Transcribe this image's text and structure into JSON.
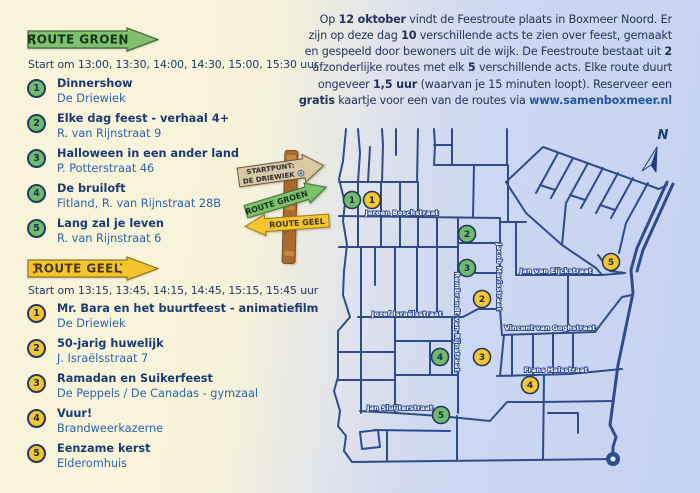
{
  "colors": {
    "green": "#6fbd6b",
    "yellow": "#f6c52d",
    "navy": "#1d3467",
    "blue_text": "#2e62ae",
    "street_blue": "#2e4c8d",
    "bg_left": "#f9f5db",
    "bg_right": "#c6d3f2",
    "post_brown": "#aa6b2c",
    "sign_beige": "#d9c9a4"
  },
  "intro": {
    "segments": [
      {
        "t": "Op "
      },
      {
        "t": "12 oktober",
        "b": true
      },
      {
        "t": " vindt de Feestroute plaats in Boxmeer Noord. Er zijn op deze dag "
      },
      {
        "t": "10",
        "b": true
      },
      {
        "t": " verschillende acts te zien over feest, gemaakt en gespeeld door bewoners uit de wijk. De Feestroute bestaat uit "
      },
      {
        "t": "2",
        "b": true
      },
      {
        "t": " afzonderlijke routes met elk "
      },
      {
        "t": "5",
        "b": true
      },
      {
        "t": " verschillende acts. Elke route duurt ongeveer "
      },
      {
        "t": "1,5 uur",
        "b": true
      },
      {
        "t": " (waarvan je 15 minuten loopt). Reserveer een "
      },
      {
        "t": "gratis",
        "b": true
      },
      {
        "t": " kaartje voor een van de routes via "
      },
      {
        "t": "www.samenboxmeer.nl",
        "b": true,
        "link": true
      }
    ]
  },
  "routes": [
    {
      "id": "groen",
      "banner": "ROUTE GROEN",
      "start": "Start om 13:00, 13:30, 14:00, 14:30, 15:00, 15:30 uur",
      "stops": [
        {
          "num": "1",
          "title": "Dinnershow",
          "location": "De Driewiek"
        },
        {
          "num": "2",
          "title": "Elke dag feest - verhaal 4+",
          "location": "R. van Rijnstraat 9"
        },
        {
          "num": "3",
          "title": "Halloween in een ander land",
          "location": "P. Potterstraat 46"
        },
        {
          "num": "4",
          "title": "De bruiloft",
          "location": "Fitland, R. van Rijnstraat 28B"
        },
        {
          "num": "5",
          "title": "Lang zal je leven",
          "location": "R. van Rijnstraat 6"
        }
      ]
    },
    {
      "id": "geel",
      "banner": "ROUTE GEEL",
      "start": "Start om 13:15, 13:45, 14:15, 14:45, 15:15, 15:45 uur",
      "stops": [
        {
          "num": "1",
          "title": "Mr. Bara en het buurtfeest - animatiefilm",
          "location": "De Driewiek"
        },
        {
          "num": "2",
          "title": "50-jarig huwelijk",
          "location": "J. Israëlsstraat 7"
        },
        {
          "num": "3",
          "title": "Ramadan en Suikerfeest",
          "location": "De Peppels / De Canadas - gymzaal"
        },
        {
          "num": "4",
          "title": "Vuur!",
          "location": "Brandweerkazerne"
        },
        {
          "num": "5",
          "title": "Eenzame kerst",
          "location": "Elderomhuis"
        }
      ]
    }
  ],
  "signpost": {
    "top_line1": "STARTPUNT:",
    "top_line2": "DE DRIEWIEK",
    "green": "ROUTE GROEN",
    "yellow": "ROUTE GEEL"
  },
  "map": {
    "compass": "N",
    "street_labels": [
      {
        "t": "Jeroen Boschstraat",
        "x": 72,
        "y": 90
      },
      {
        "t": "Jan van Eijckstraat",
        "x": 226,
        "y": 148
      },
      {
        "t": "Jozef Israëlsstraat",
        "x": 77,
        "y": 191
      },
      {
        "t": "Vincent van Goghstraat",
        "x": 220,
        "y": 205
      },
      {
        "t": "Frans Halsstraat",
        "x": 226,
        "y": 247
      },
      {
        "t": "Jan Sluijterstraat",
        "x": 70,
        "y": 285
      },
      {
        "t": "Rembrandt van Rijnstraat",
        "x": 125,
        "y": 197,
        "v": true
      },
      {
        "t": "Jacob Marisstraat",
        "x": 167,
        "y": 152,
        "v": true
      }
    ],
    "markers": [
      {
        "c": "green",
        "n": "1",
        "x": 22,
        "y": 75
      },
      {
        "c": "yellow",
        "n": "1",
        "x": 42,
        "y": 75
      },
      {
        "c": "green",
        "n": "2",
        "x": 137,
        "y": 109
      },
      {
        "c": "green",
        "n": "3",
        "x": 137,
        "y": 143
      },
      {
        "c": "yellow",
        "n": "2",
        "x": 152,
        "y": 174
      },
      {
        "c": "yellow",
        "n": "5",
        "x": 281,
        "y": 137
      },
      {
        "c": "green",
        "n": "4",
        "x": 110,
        "y": 232
      },
      {
        "c": "yellow",
        "n": "3",
        "x": 152,
        "y": 232
      },
      {
        "c": "yellow",
        "n": "4",
        "x": 200,
        "y": 260
      },
      {
        "c": "green",
        "n": "5",
        "x": 111,
        "y": 290
      }
    ]
  }
}
